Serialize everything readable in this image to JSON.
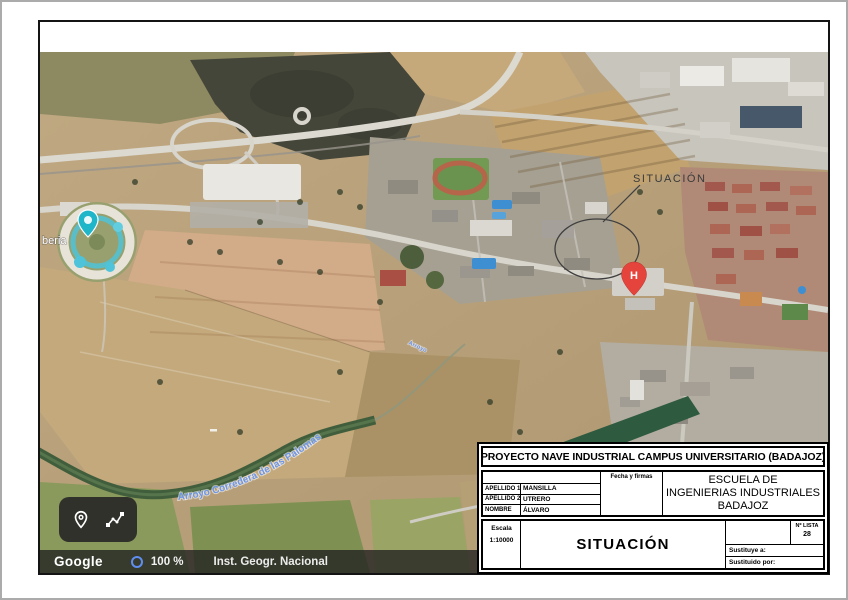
{
  "drawing": {
    "project_title": "PROYECTO NAVE INDUSTRIAL CAMPUS UNIVERSITARIO (BADAJOZ)",
    "author_rows": [
      {
        "label": "APELLIDO 1",
        "value": "MANSILLA"
      },
      {
        "label": "APELLIDO 2",
        "value": "UTRERO"
      },
      {
        "label": "NOMBRE",
        "value": "ÁLVARO"
      }
    ],
    "fecha_firmas_label": "Fecha y firmas",
    "school": {
      "line1": "ESCUELA DE",
      "line2": "INGENIERIAS INDUSTRIALES",
      "line3": "BADAJOZ"
    },
    "escala": {
      "label": "Escala",
      "value": "1:10000"
    },
    "sheet_title": "SITUACIÓN",
    "lista": {
      "label": "Nº LISTA",
      "value": "28"
    },
    "sustituye_label": "Sustituye a:",
    "sustituido_label": "Sustituido por:"
  },
  "map": {
    "annotation_label": "SITUACIÓN",
    "hospital_marker_letter": "H",
    "river_label": "Arroyo Corredera de las Palomas",
    "stream_label": "Arroyo",
    "waterpark_label_partial": "beria",
    "attribution": {
      "brand": "Google",
      "zoom": "100 %",
      "source": "Inst. Geogr. Nacional"
    },
    "colors": {
      "hospital_pin": "#e5443c",
      "waterpark_pin": "#1fb6c9",
      "water_label": "#6e95e6",
      "zoom_ring": "#5f8ef0"
    }
  }
}
